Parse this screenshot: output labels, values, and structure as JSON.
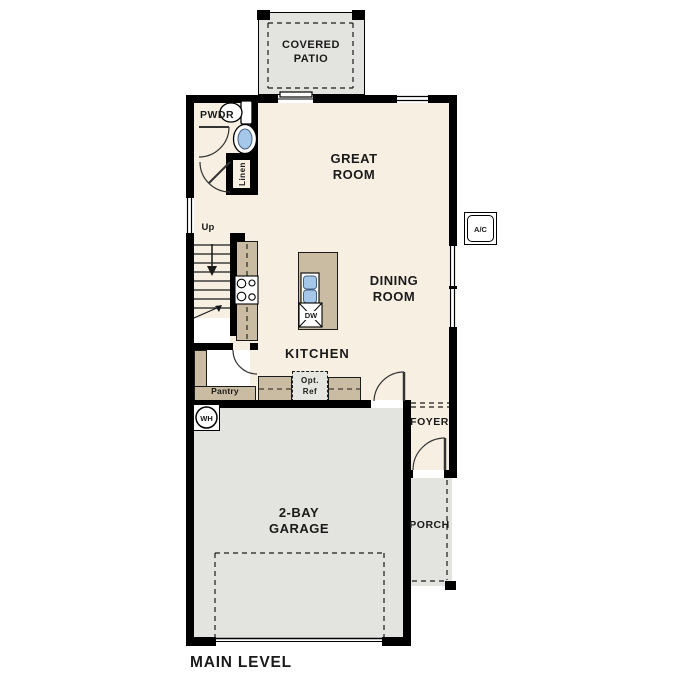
{
  "title": "MAIN LEVEL",
  "colors": {
    "floor": "#f7efe2",
    "concrete": "#e3e3e0",
    "counter": "#c9bca2",
    "wall": "#000000",
    "fixture_blue": "#a5c7e9",
    "text": "#1a1a1a"
  },
  "rooms": {
    "covered_patio": "COVERED PATIO",
    "great_room": "GREAT ROOM",
    "dining_room": "DINING ROOM",
    "kitchen": "KITCHEN",
    "garage": "2-BAY GARAGE",
    "foyer": "FOYER",
    "porch": "PORCH",
    "powder": "PWDR"
  },
  "features": {
    "linen": "Linen",
    "pantry": "Pantry",
    "stairs_up": "Up",
    "opt_ref": "Opt. Ref",
    "dishwasher": "DW",
    "water_heater": "WH",
    "ac_unit": "A/C"
  }
}
